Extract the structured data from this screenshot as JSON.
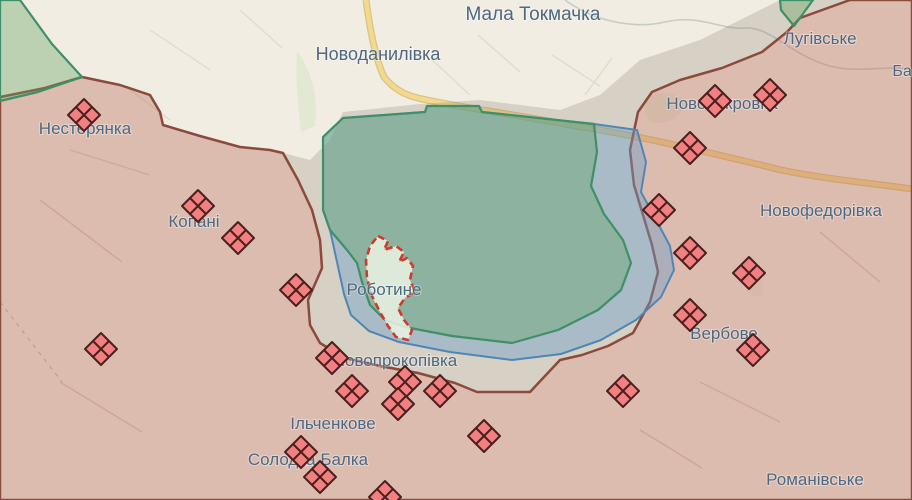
{
  "map": {
    "description": "frontline-map-robotyne-area",
    "region_labels": [
      {
        "text": "Мала Токмачка",
        "x": 533,
        "y": 20,
        "size": 19
      },
      {
        "text": "Новоданилівка",
        "x": 378,
        "y": 60,
        "size": 18
      },
      {
        "text": "Лугівське",
        "x": 820,
        "y": 44,
        "size": 17
      },
      {
        "text": "Баг",
        "x": 905,
        "y": 76,
        "size": 16
      },
      {
        "text": "Нестерянка",
        "x": 85,
        "y": 134,
        "size": 17
      },
      {
        "text": "Новопокровка",
        "x": 722,
        "y": 109,
        "size": 17
      },
      {
        "text": "Копані",
        "x": 194,
        "y": 227,
        "size": 17
      },
      {
        "text": "Новофедорівка",
        "x": 821,
        "y": 216,
        "size": 17
      },
      {
        "text": "Роботине",
        "x": 384,
        "y": 295,
        "size": 17
      },
      {
        "text": "Вербове",
        "x": 724,
        "y": 339,
        "size": 17
      },
      {
        "text": "Новопрокопівка",
        "x": 395,
        "y": 366,
        "size": 17
      },
      {
        "text": "Ільченкове",
        "x": 333,
        "y": 429,
        "size": 17
      },
      {
        "text": "Солодка Балка",
        "x": 308,
        "y": 465,
        "size": 17
      },
      {
        "text": "Романівське",
        "x": 815,
        "y": 485,
        "size": 17
      }
    ],
    "markers": [
      {
        "x": 84,
        "y": 115
      },
      {
        "x": 198,
        "y": 206
      },
      {
        "x": 238,
        "y": 238
      },
      {
        "x": 296,
        "y": 290
      },
      {
        "x": 101,
        "y": 349
      },
      {
        "x": 332,
        "y": 358
      },
      {
        "x": 352,
        "y": 391
      },
      {
        "x": 405,
        "y": 382
      },
      {
        "x": 398,
        "y": 404
      },
      {
        "x": 440,
        "y": 391
      },
      {
        "x": 484,
        "y": 436
      },
      {
        "x": 301,
        "y": 452
      },
      {
        "x": 320,
        "y": 477
      },
      {
        "x": 385,
        "y": 497
      },
      {
        "x": 623,
        "y": 391
      },
      {
        "x": 753,
        "y": 350
      },
      {
        "x": 659,
        "y": 210
      },
      {
        "x": 690,
        "y": 253
      },
      {
        "x": 749,
        "y": 273
      },
      {
        "x": 690,
        "y": 315
      },
      {
        "x": 715,
        "y": 101
      },
      {
        "x": 770,
        "y": 95
      },
      {
        "x": 690,
        "y": 148
      }
    ],
    "colors": {
      "background": "#f2ede2",
      "occupied_fill": "rgba(186,108,94,0.38)",
      "occupied_border": "#8a4a3c",
      "liberated_fill": "rgba(96,162,96,0.38)",
      "liberated_border": "#3f8f68",
      "advance_fill": "rgba(106,158,199,0.42)",
      "advance_border": "#4e87b5",
      "grey_zone_fill": "rgba(138,128,112,0.26)",
      "contested_outline": "#cf3a2c",
      "contested_fill": "rgba(235,243,228,0.85)",
      "marker_fill": "#f28080",
      "marker_border": "#4c1f1f",
      "road": "#ecd083",
      "label_color": "#4d6880"
    }
  }
}
